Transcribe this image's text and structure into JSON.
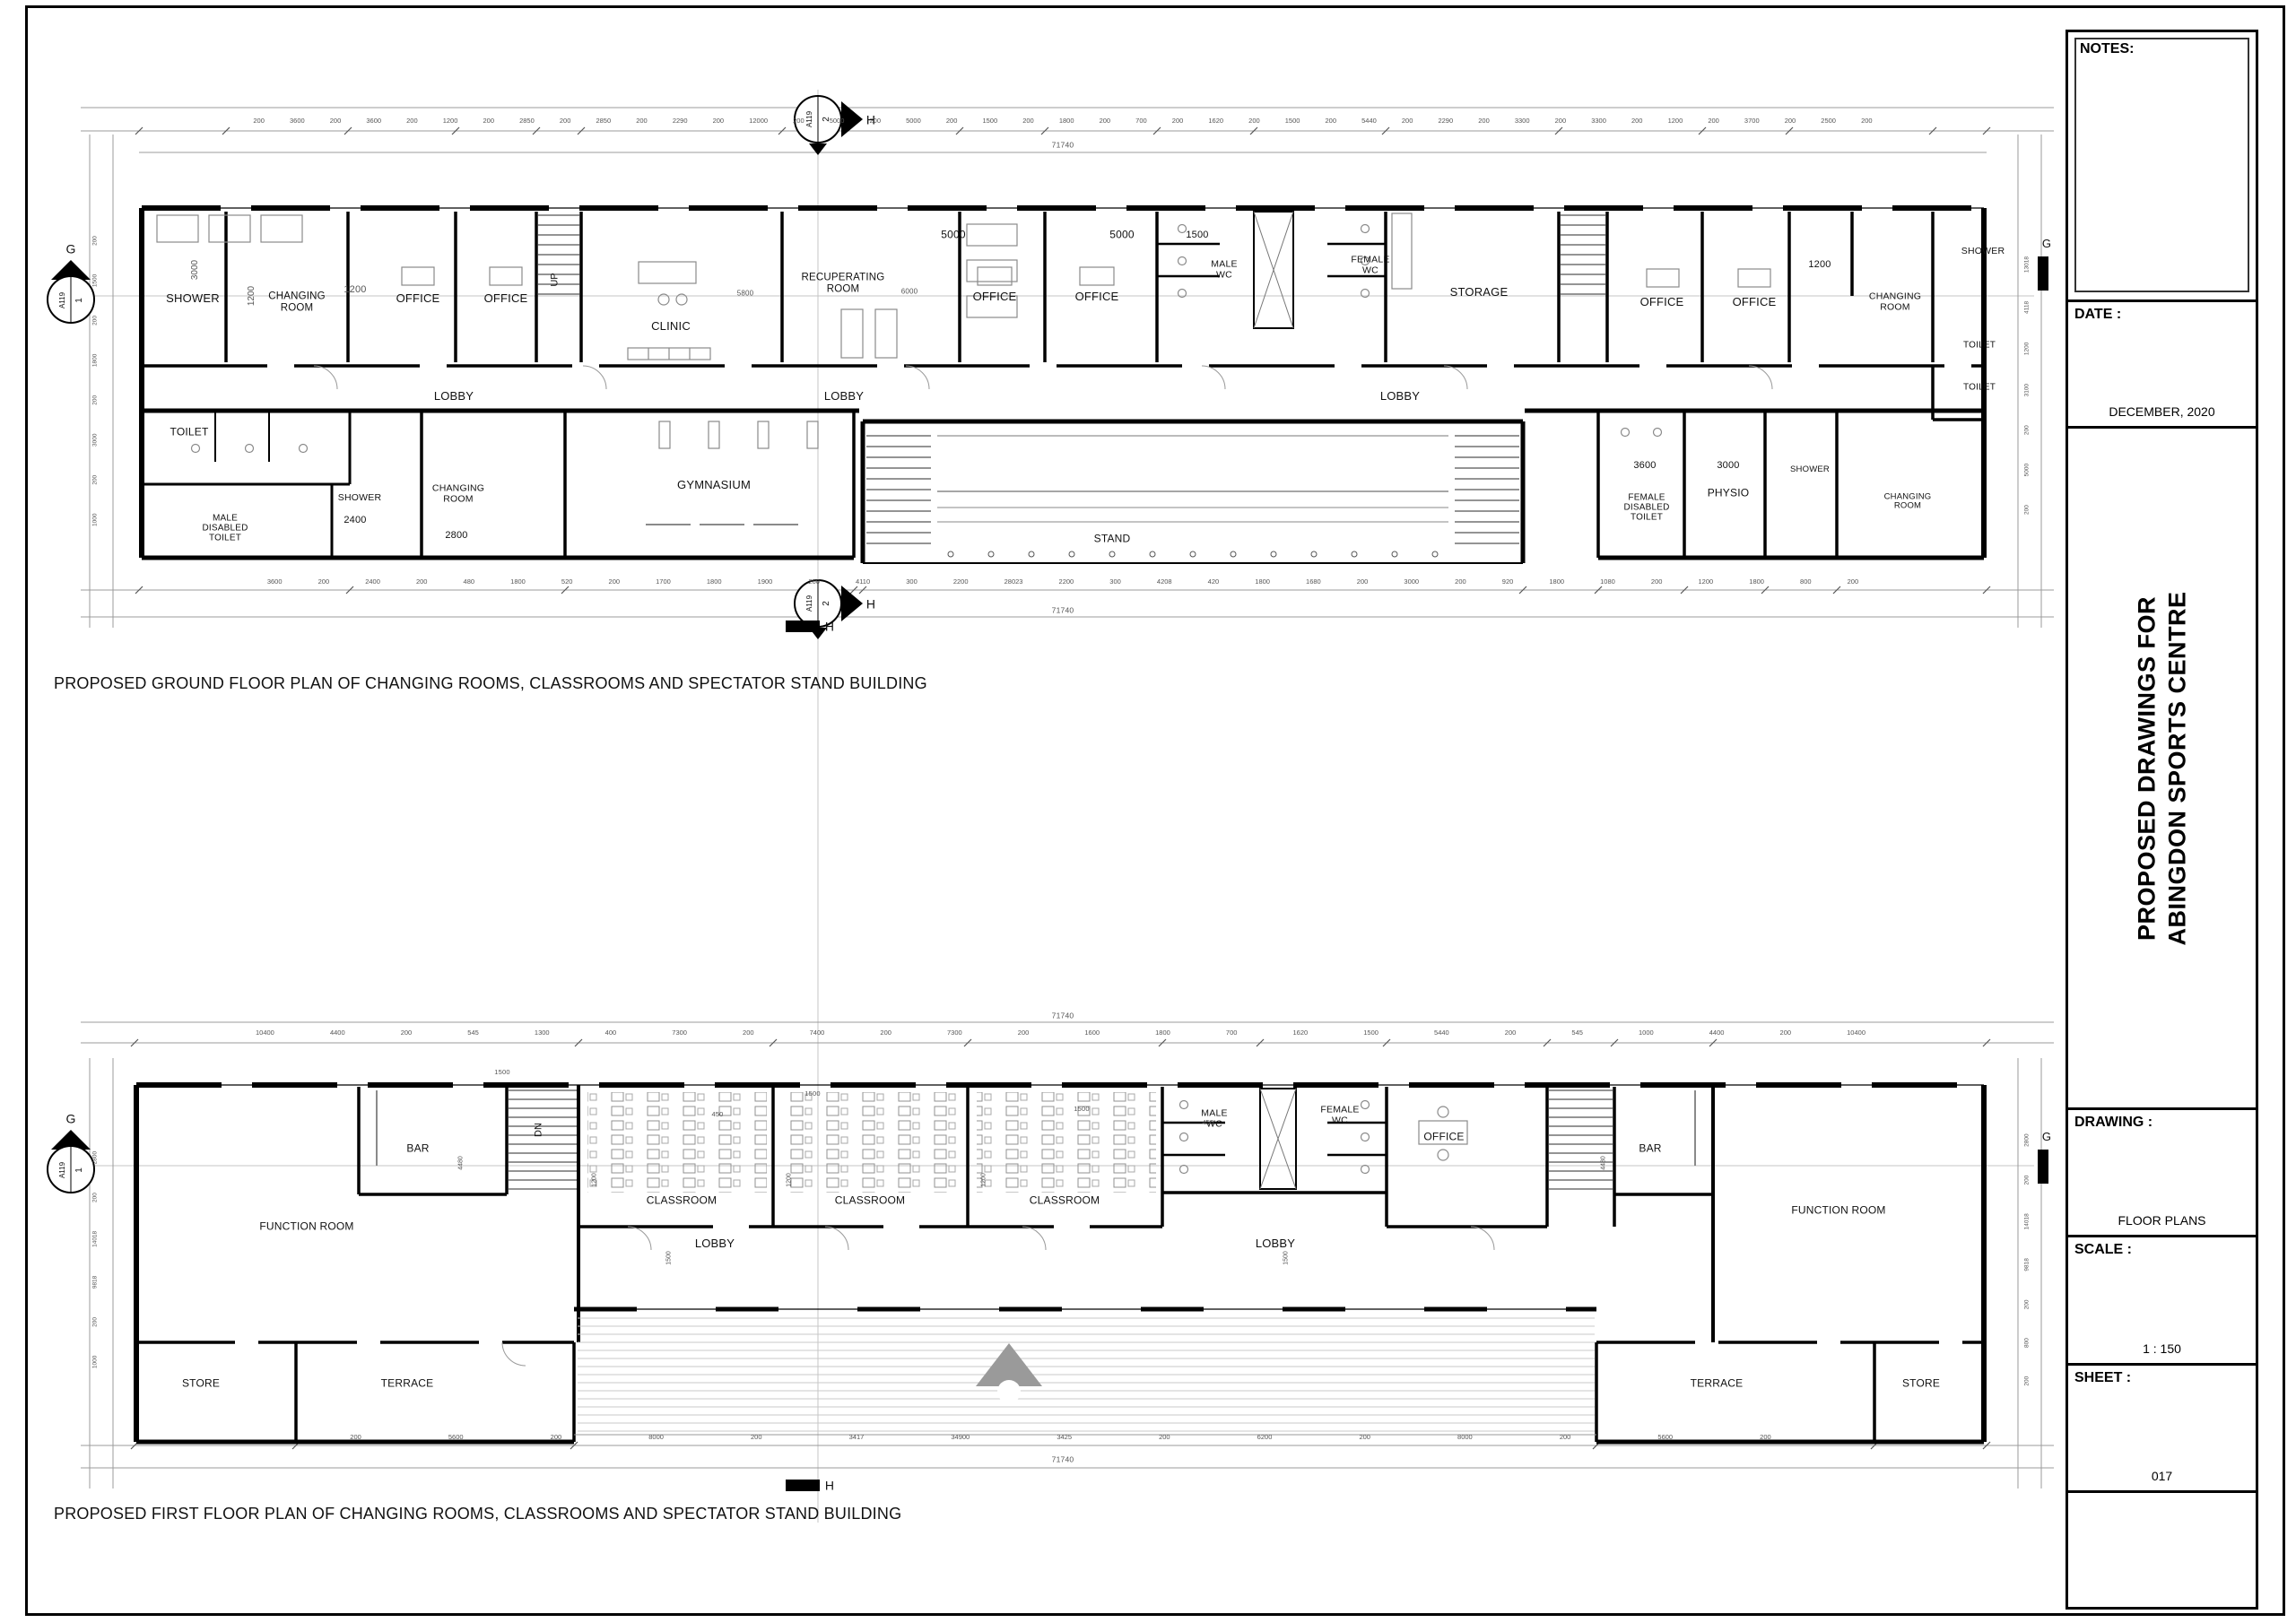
{
  "meta": {
    "palette": {
      "line": "#000000",
      "dim": "#777777",
      "furniture": "#909090"
    }
  },
  "captions": {
    "ground": "PROPOSED GROUND FLOOR PLAN OF CHANGING ROOMS, CLASSROOMS AND SPECTATOR STAND BUILDING",
    "first": "PROPOSED FIRST FLOOR PLAN OF CHANGING ROOMS, CLASSROOMS AND SPECTATOR STAND BUILDING"
  },
  "titleblock": {
    "notes_label": "NOTES:",
    "date_label": "DATE :",
    "date_value": "DECEMBER, 2020",
    "project_title": "PROPOSED DRAWINGS FOR\nABINGDON SPORTS CENTRE",
    "drawing_label": "DRAWING :",
    "drawing_value": "FLOOR PLANS",
    "scale_label": "SCALE :",
    "scale_value": "1 : 150",
    "sheet_label": "SHEET :",
    "sheet_value": "017"
  },
  "markers": {
    "ref": "A119",
    "num_h": "2",
    "num_g": "1",
    "letter_h": "H",
    "letter_g": "G"
  },
  "ground": {
    "labels": [
      "3000",
      "SHOWER",
      "1200",
      "CHANGING\nROOM",
      "1200",
      "OFFICE",
      "OFFICE",
      "UP",
      "CLINIC",
      "5800",
      "RECUPERATING\nROOM",
      "6000",
      "5000",
      "OFFICE",
      "OFFICE",
      "5000",
      "1500",
      "MALE\nWC",
      "FEMALE\nWC",
      "STORAGE",
      "OFFICE",
      "OFFICE",
      "1200",
      "CHANGING\nROOM",
      "SHOWER",
      "TOILET",
      "TOILET",
      "LOBBY",
      "LOBBY",
      "LOBBY",
      "TOILET",
      "MALE\nDISABLED\nTOILET",
      "SHOWER",
      "2400",
      "CHANGING\nROOM",
      "2800",
      "GYMNASIUM",
      "STAND",
      "3600",
      "FEMALE\nDISABLED\nTOILET",
      "3000",
      "PHYSIO",
      "SHOWER",
      "CHANGING\nROOM"
    ],
    "dims": {
      "top_total": "71740",
      "top_chain": "200 3600 200 3600 200 1200 200 2850 200 2850 200 2290 200 12000 200 5000 200 5000 200 1500 200 1800 200 700 200 1620 200 1500 200 5440 200 2290 200 3300 200 3300 200 1200 200 3700 200 2500 200",
      "bottom_chain": "3600 200 2400 200 480 1800 520 200 1700 1800 1900 200 4110 300 2200 28023 2200 300 4208 420 1800 1680 200 3000 200 920 1800 1080 200 1200 1800 800 200",
      "bottom_total": "71740",
      "left_chain": "1000 200 3000 200 1800 200 1500 200",
      "right_chain": "200 5000 200 3100 1200 4118 13018"
    }
  },
  "first": {
    "labels": [
      "FUNCTION ROOM",
      "BAR",
      "DN",
      "CLASSROOM",
      "CLASSROOM",
      "CLASSROOM",
      "MALE\nWC",
      "FEMALE\nWC",
      "OFFICE",
      "BAR",
      "FUNCTION ROOM",
      "LOBBY",
      "LOBBY",
      "STORE",
      "TERRACE",
      "TERRACE",
      "STORE"
    ],
    "dims": {
      "top_total": "71740",
      "top_chain": "10400 4400 200 545 1300 400 7300 200 7400 200 7300 200 1600 1800 700 1620 1500 5440 200 545 1000 4400 200 10400",
      "bottom_chain": "200 5600 200 8000 200 3417 34900 3425 200 6200 200 8000 200 5600 200",
      "bottom_total": "71740",
      "left_chain": "1000 200 9818 14018 200 2800",
      "right_chain": "200 800 200 9818 14018 200 2800",
      "small": [
        "1500",
        "1500",
        "1500",
        "450",
        "450",
        "1200",
        "1200",
        "1200",
        "1500",
        "1500",
        "4480",
        "4480"
      ]
    }
  }
}
